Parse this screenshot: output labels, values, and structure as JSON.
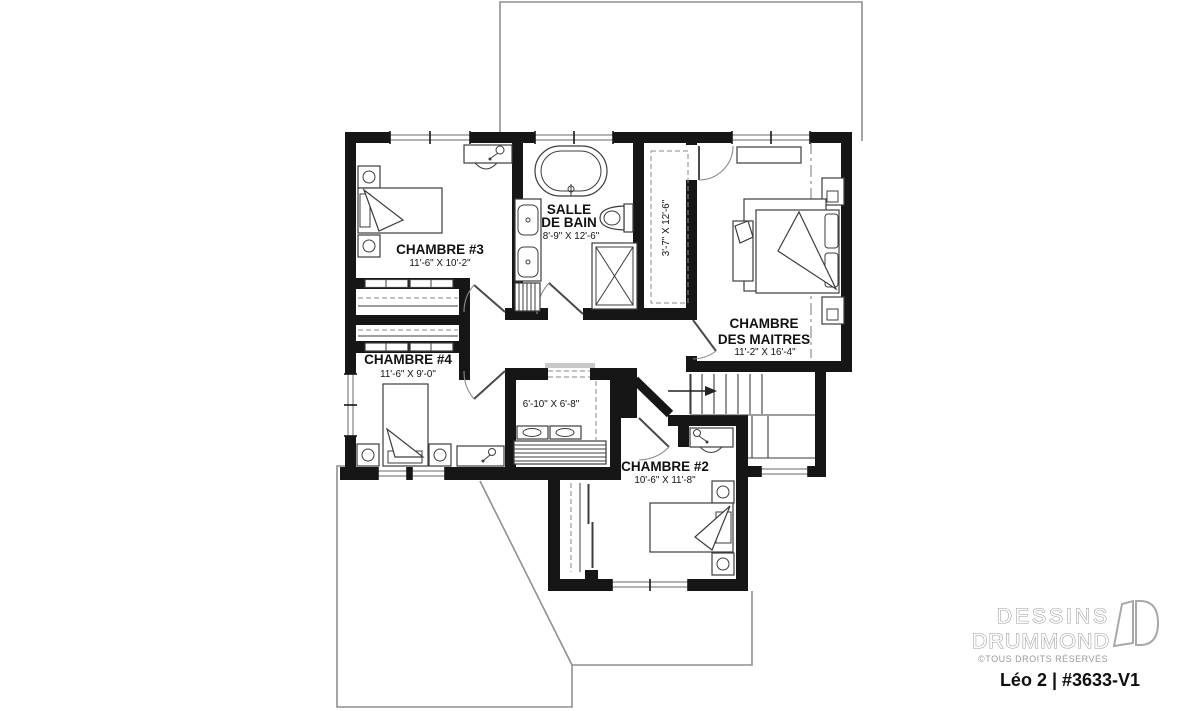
{
  "colors": {
    "wall": "#161616",
    "text": "#111111",
    "logo_gray": "#9b9b9b"
  },
  "rooms": {
    "chambre3": {
      "name": "CHAMBRE #3",
      "dims": "11'-6\" X 10'-2\""
    },
    "bath": {
      "name_line1": "SALLE",
      "name_line2": "DE BAIN",
      "dims": "8'-9\" X 12'-6\""
    },
    "walkin": {
      "dims": "3'-7\" X 12'-6\""
    },
    "master": {
      "name_line1": "CHAMBRE",
      "name_line2": "DES MAITRES",
      "dims": "11'-2\" X 16'-4\""
    },
    "chambre4": {
      "name": "CHAMBRE #4",
      "dims": "11'-6\" X 9'-0\""
    },
    "laundry": {
      "dims": "6'-10\" X 6'-8\""
    },
    "chambre2": {
      "name": "CHAMBRE #2",
      "dims": "10'-6\" X 11'-8\""
    }
  },
  "branding": {
    "company_line1": "DESSINS",
    "company_line2": "DRUMMOND",
    "rights": "©TOUS DROITS RÉSERVÉS",
    "plan_id": "Léo 2 | #3633-V1"
  }
}
